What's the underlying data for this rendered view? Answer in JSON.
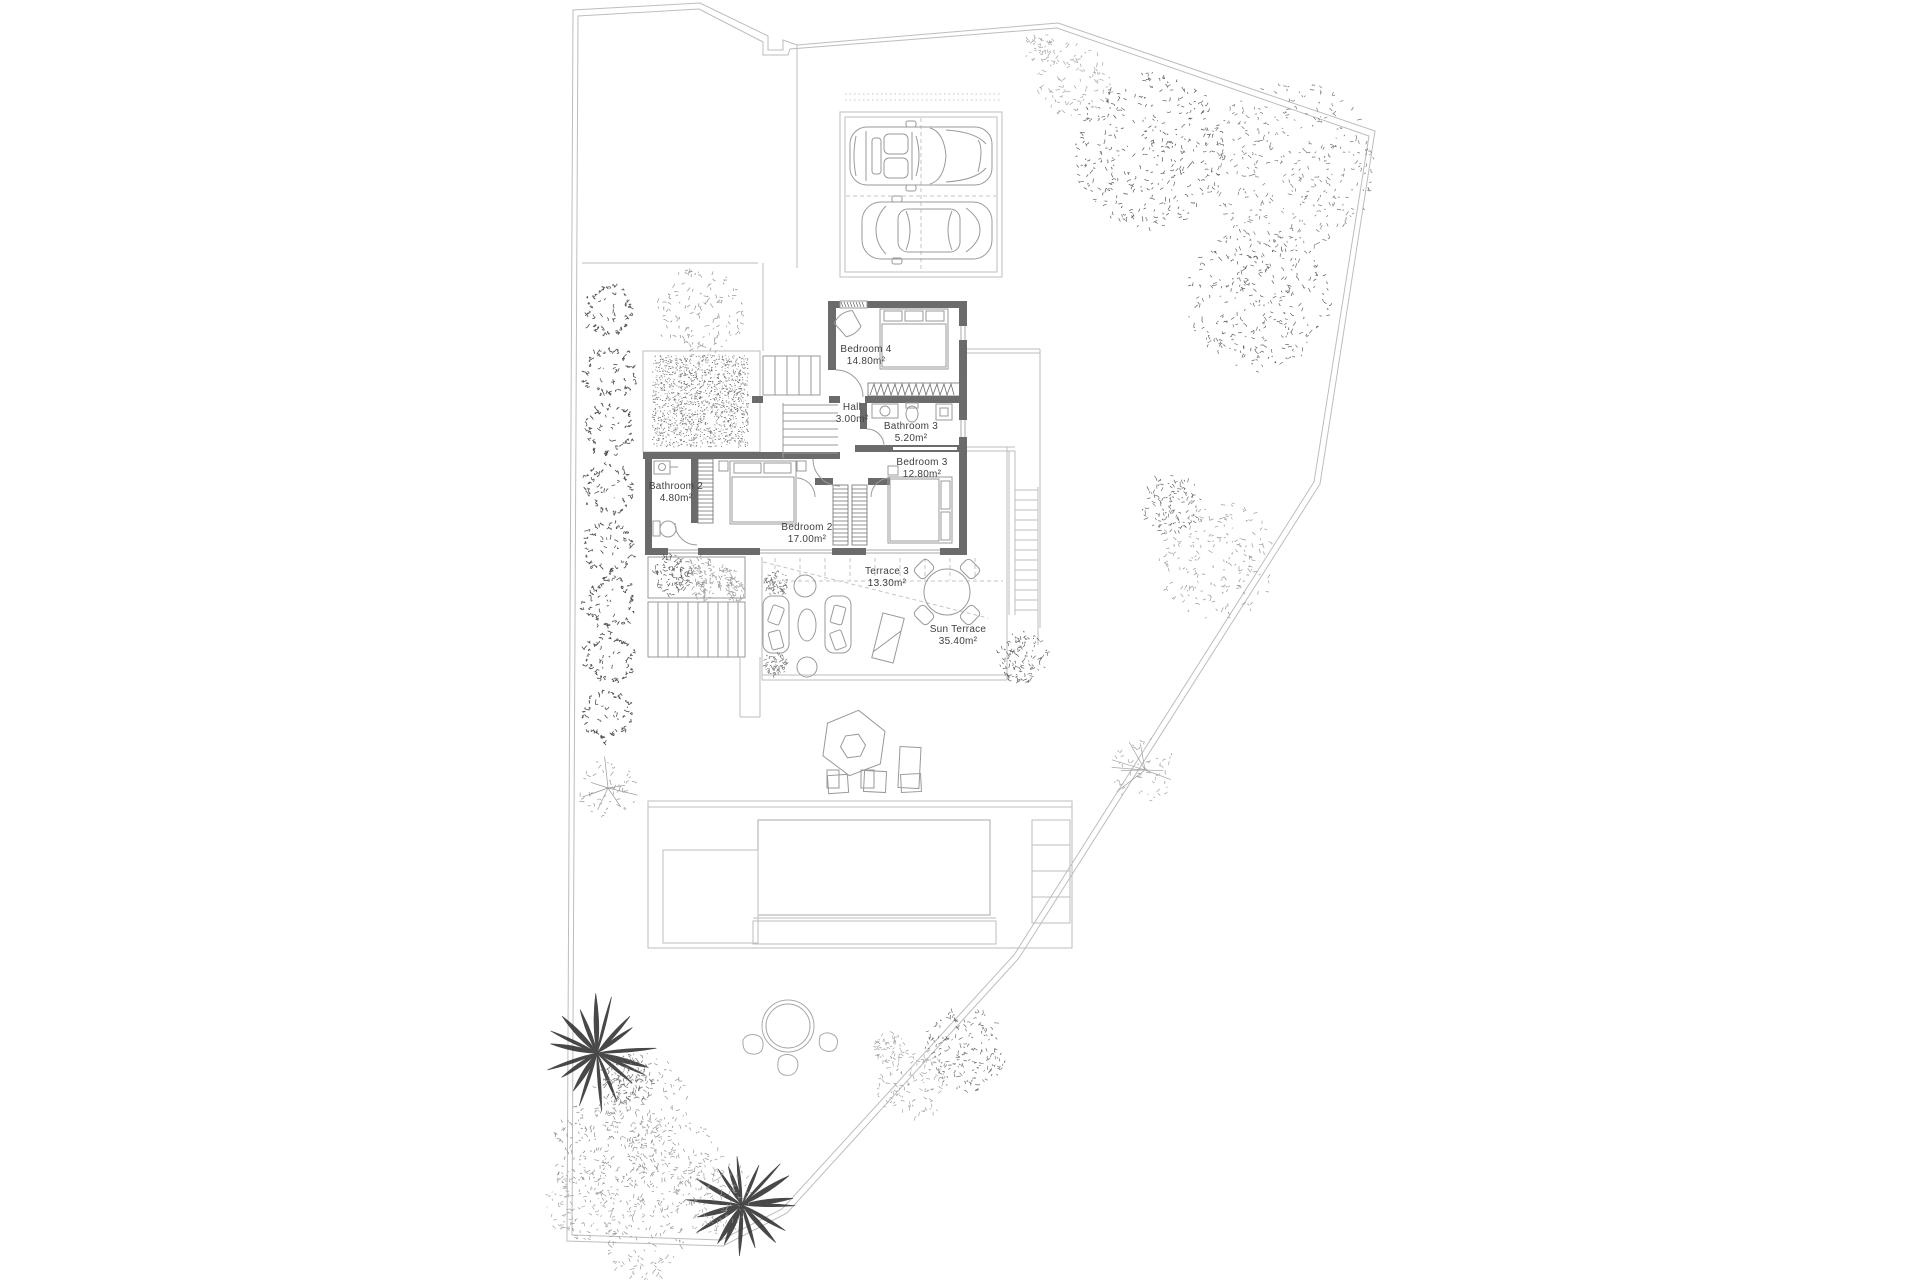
{
  "plan": {
    "title": "Villa upper floor site plan",
    "rooms": [
      {
        "name": "Bedroom 4",
        "area": "14.80m²"
      },
      {
        "name": "Hall",
        "area": "3.00m²"
      },
      {
        "name": "Bathroom 3",
        "area": "5.20m²"
      },
      {
        "name": "Bedroom 3",
        "area": "12.80m²"
      },
      {
        "name": "Bathroom 2",
        "area": "4.80m²"
      },
      {
        "name": "Bedroom 2",
        "area": "17.00m²"
      },
      {
        "name": "Terrace 3",
        "area": "13.30m²"
      },
      {
        "name": "Sun Terrace",
        "area": "35.40m²"
      }
    ],
    "colors": {
      "wall": "#6b6b6b",
      "thin_line": "#bdbdbd",
      "text": "#3f3f3f",
      "background": "#ffffff"
    }
  }
}
